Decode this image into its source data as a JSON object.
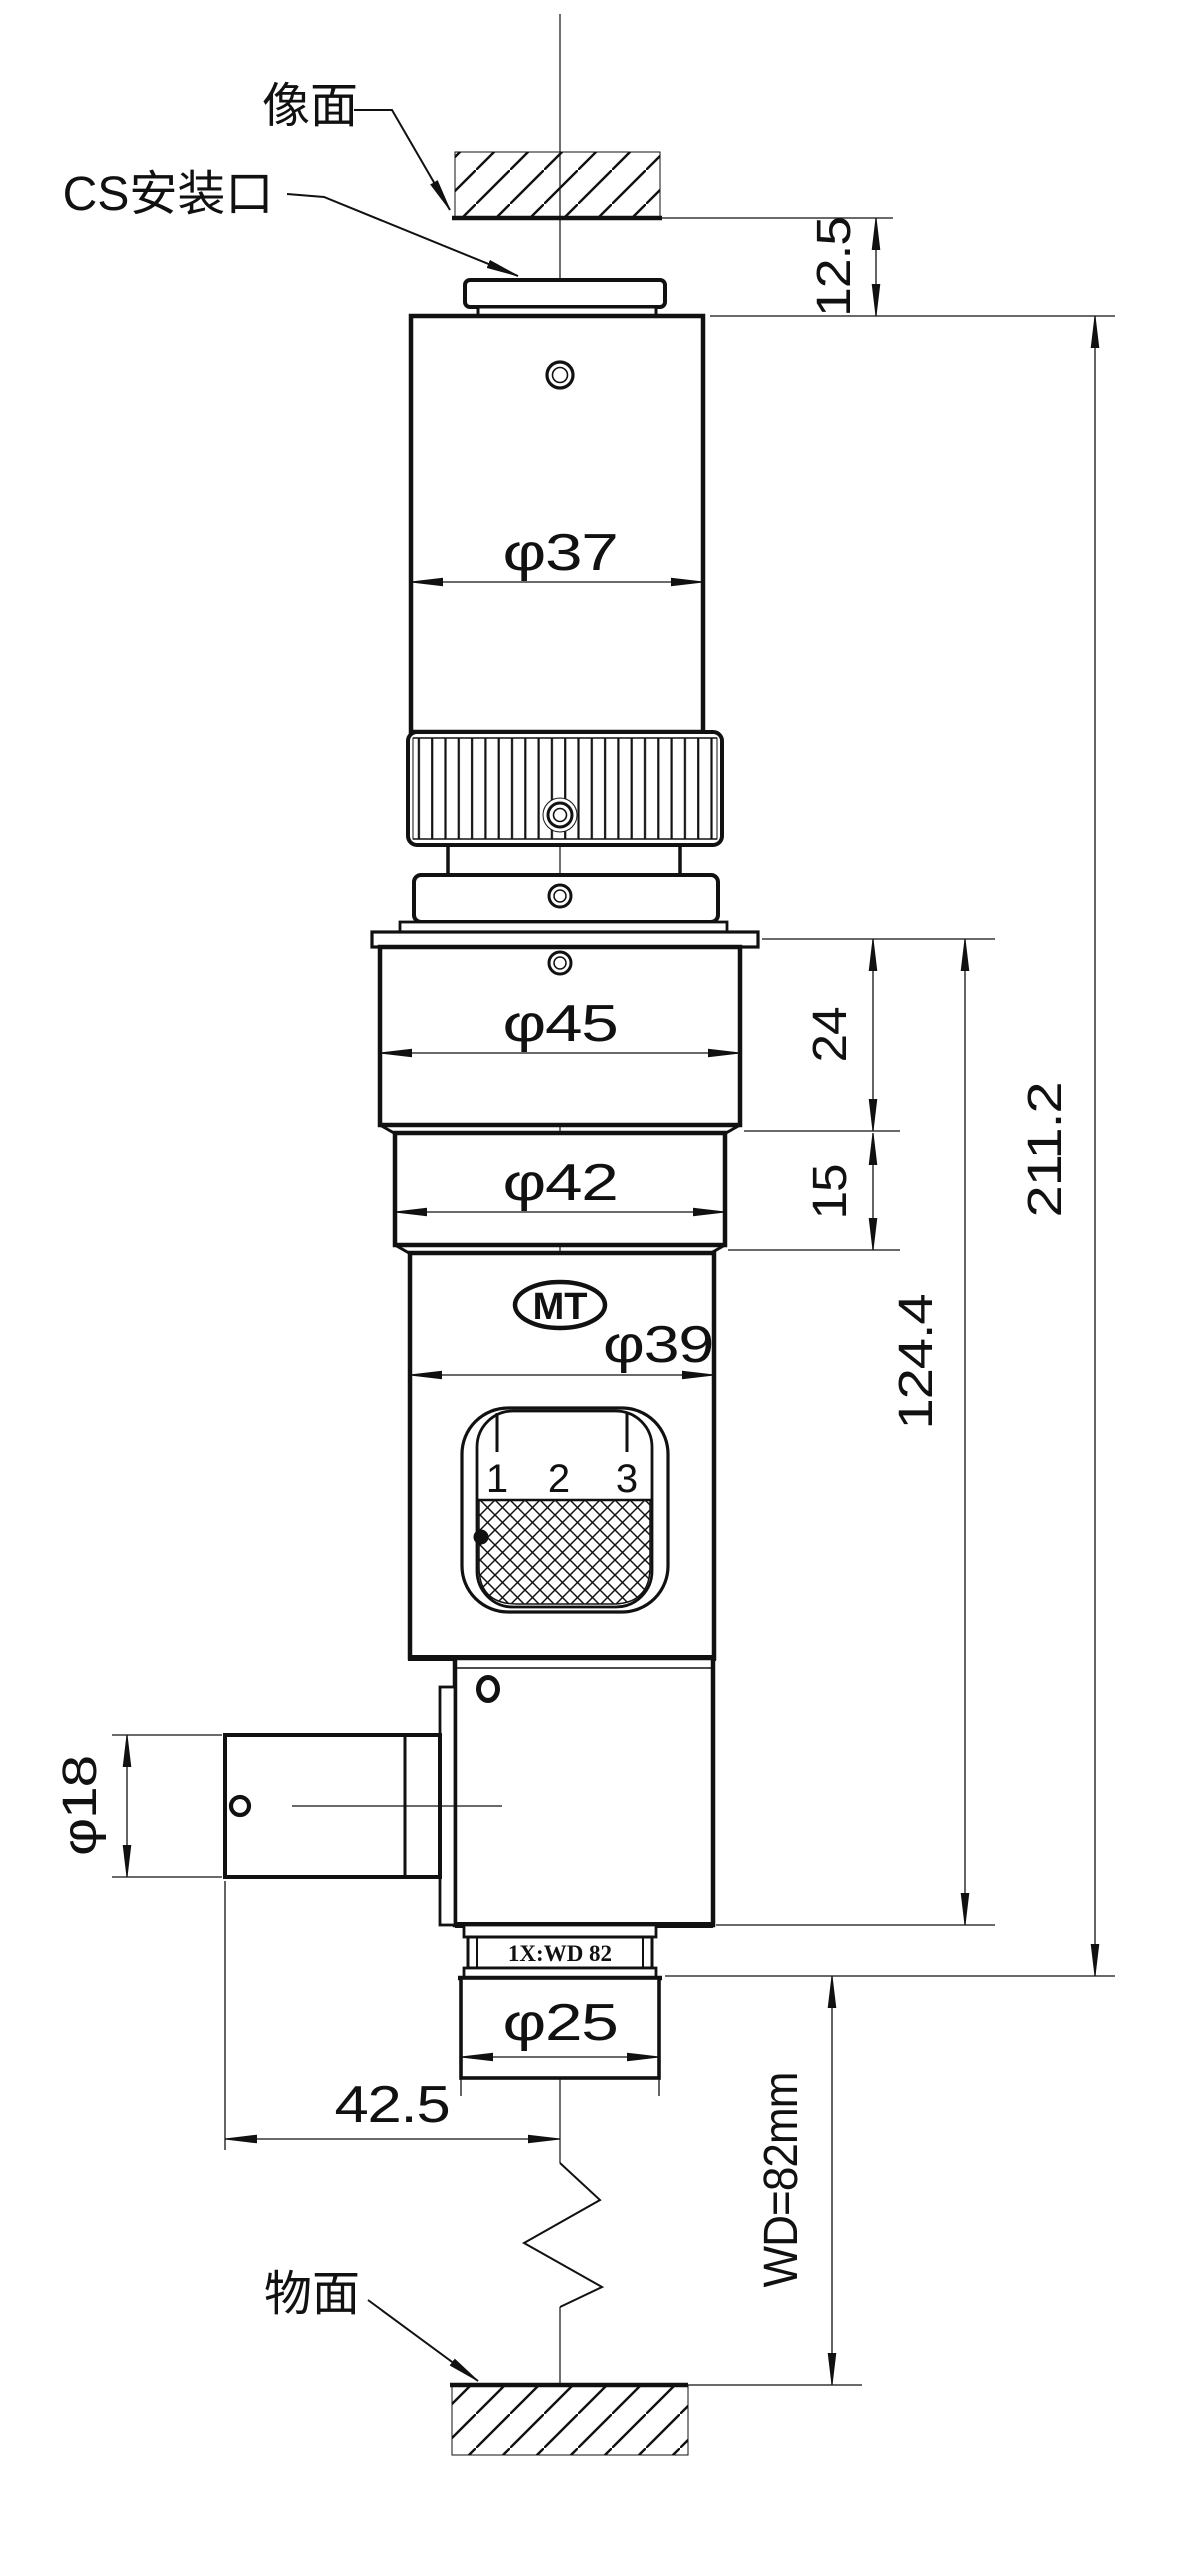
{
  "labels": {
    "image_plane": "像面",
    "cs_mount": "CS安装口",
    "object_plane": "物面"
  },
  "markings": {
    "logo": "MT",
    "front_ring": "1X:WD 82",
    "scale_ticks": [
      "1",
      "2",
      "3"
    ]
  },
  "dims": {
    "flange_to_image": "12.5",
    "body_dia": "φ37",
    "upper_dia": "φ45",
    "upper_len": "24",
    "mid_len": "15",
    "mid_dia": "φ42",
    "lower_dia": "φ39",
    "overall_len": "211.2",
    "lower_len": "124.4",
    "port_dia": "φ18",
    "front_dia": "φ25",
    "port_offset": "42.5",
    "working_distance": "WD=82mm"
  },
  "line_color": "#111111",
  "background": "#ffffff"
}
